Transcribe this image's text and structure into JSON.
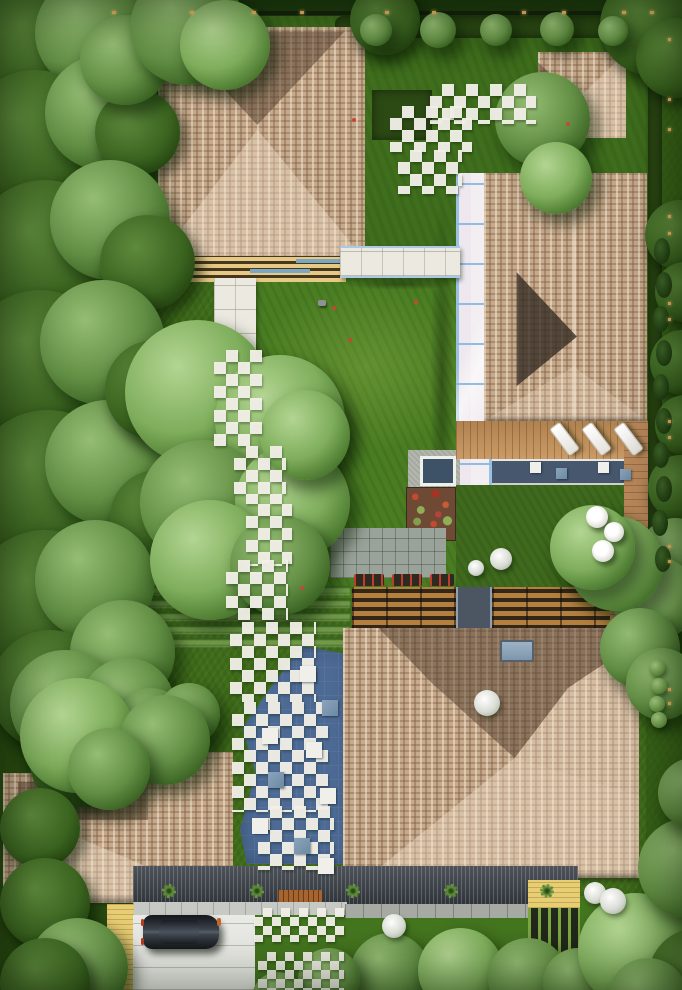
{
  "title": "aerial-top-view-residential-garden-render",
  "palette": {
    "lawn": "#3e6a1b",
    "lawn_bright": "#4a7d22",
    "boundary_dark": "#1d3a0e",
    "roof_shingle": "#c7a98b",
    "roof_dark_slope": "#54402f",
    "roof_light_slope": "#f4e3cc",
    "paver_white": "#f1efe9",
    "paving_blue": "#4d6a94",
    "pool_water": "#47586e",
    "glass_walkway": "#cfe0f0",
    "deck_wood": "#c1905a",
    "slat_wood": "#b5803f",
    "canopy_dark": "#3e444b",
    "driveway": "#e9eae5",
    "deck_yellow": "#e7cd74",
    "flower_red": "#c24a33",
    "light_warm": "#f0b25a",
    "car_body": "#14171b"
  },
  "scene": {
    "trees": [
      [
        -30,
        -20,
        130,
        "d"
      ],
      [
        35,
        -25,
        115,
        "m"
      ],
      [
        -35,
        70,
        140,
        "d"
      ],
      [
        45,
        55,
        115,
        "m"
      ],
      [
        95,
        90,
        85,
        "d"
      ],
      [
        80,
        15,
        90,
        "m"
      ],
      [
        -30,
        180,
        150,
        "d"
      ],
      [
        50,
        160,
        120,
        "m"
      ],
      [
        100,
        215,
        95,
        "d"
      ],
      [
        -35,
        290,
        150,
        "d"
      ],
      [
        40,
        280,
        125,
        "m"
      ],
      [
        -30,
        410,
        155,
        "d"
      ],
      [
        45,
        400,
        125,
        "m"
      ],
      [
        105,
        340,
        100,
        "d"
      ],
      [
        110,
        470,
        95,
        "d"
      ],
      [
        -30,
        530,
        150,
        "d"
      ],
      [
        35,
        520,
        120,
        "m"
      ],
      [
        -10,
        630,
        120,
        "d"
      ],
      [
        70,
        600,
        105,
        "m"
      ],
      [
        125,
        320,
        145,
        "l"
      ],
      [
        215,
        355,
        130,
        "l"
      ],
      [
        140,
        440,
        125,
        "m"
      ],
      [
        235,
        445,
        115,
        "l"
      ],
      [
        260,
        390,
        90,
        "l"
      ],
      [
        150,
        500,
        120,
        "l"
      ],
      [
        230,
        515,
        100,
        "m"
      ],
      [
        130,
        -30,
        115,
        "m"
      ],
      [
        180,
        0,
        90,
        "l"
      ],
      [
        350,
        -15,
        70,
        "d"
      ],
      [
        600,
        -25,
        100,
        "d"
      ],
      [
        636,
        18,
        80,
        "d"
      ],
      [
        360,
        14,
        32,
        "m"
      ],
      [
        420,
        12,
        36,
        "m"
      ],
      [
        480,
        14,
        32,
        "m"
      ],
      [
        540,
        12,
        34,
        "m"
      ],
      [
        598,
        16,
        30,
        "m"
      ],
      [
        495,
        72,
        95,
        "m"
      ],
      [
        520,
        142,
        72,
        "l"
      ],
      [
        645,
        200,
        70,
        "d"
      ],
      [
        655,
        262,
        60,
        "d"
      ],
      [
        650,
        330,
        65,
        "d"
      ],
      [
        655,
        395,
        60,
        "d"
      ],
      [
        648,
        455,
        65,
        "d"
      ],
      [
        638,
        518,
        75,
        "m"
      ],
      [
        612,
        556,
        85,
        "l"
      ],
      [
        568,
        516,
        95,
        "l"
      ],
      [
        550,
        505,
        85,
        "l"
      ],
      [
        600,
        608,
        80,
        "m"
      ],
      [
        626,
        648,
        72,
        "m"
      ],
      [
        10,
        650,
        110,
        "m"
      ],
      [
        80,
        658,
        95,
        "m"
      ],
      [
        30,
        718,
        90,
        "d"
      ],
      [
        110,
        688,
        80,
        "m"
      ],
      [
        158,
        683,
        62,
        "m"
      ],
      [
        20,
        678,
        115,
        "l"
      ],
      [
        120,
        695,
        90,
        "m"
      ],
      [
        68,
        728,
        82,
        "m"
      ],
      [
        0,
        788,
        80,
        "d"
      ],
      [
        0,
        858,
        90,
        "d"
      ],
      [
        28,
        918,
        100,
        "m"
      ],
      [
        0,
        938,
        90,
        "d"
      ],
      [
        350,
        933,
        80,
        "m"
      ],
      [
        418,
        928,
        85,
        "l"
      ],
      [
        488,
        938,
        80,
        "m"
      ],
      [
        543,
        948,
        70,
        "m"
      ],
      [
        298,
        948,
        62,
        "m"
      ],
      [
        252,
        972,
        52,
        "m"
      ],
      [
        578,
        893,
        115,
        "l"
      ],
      [
        638,
        818,
        100,
        "m"
      ],
      [
        648,
        928,
        100,
        "d"
      ],
      [
        608,
        958,
        80,
        "m"
      ],
      [
        658,
        758,
        70,
        "m"
      ]
    ],
    "conifers_right": [
      [
        654,
        238
      ],
      [
        656,
        272
      ],
      [
        653,
        306
      ],
      [
        656,
        340
      ],
      [
        653,
        374
      ],
      [
        656,
        408
      ],
      [
        653,
        442
      ],
      [
        656,
        476
      ],
      [
        652,
        510
      ],
      [
        655,
        546
      ]
    ],
    "hedge_balls": [
      [
        649,
        660
      ],
      [
        651,
        678
      ],
      [
        649,
        696
      ],
      [
        651,
        712
      ]
    ],
    "checker_clusters": [
      [
        430,
        84,
        106,
        40
      ],
      [
        390,
        106,
        82,
        46
      ],
      [
        398,
        150,
        64,
        44
      ],
      [
        214,
        350,
        48,
        96
      ],
      [
        234,
        446,
        52,
        58
      ],
      [
        246,
        504,
        46,
        62
      ],
      [
        226,
        560,
        62,
        60
      ],
      [
        230,
        622,
        86,
        80
      ],
      [
        232,
        702,
        96,
        110
      ],
      [
        258,
        806,
        76,
        64
      ]
    ],
    "checker_green": [
      [
        254,
        908,
        90,
        34
      ],
      [
        258,
        952,
        86,
        38
      ]
    ],
    "terrace_tiles": [
      [
        300,
        666,
        "w"
      ],
      [
        322,
        700,
        "g"
      ],
      [
        262,
        728,
        "w"
      ],
      [
        306,
        742,
        "w"
      ],
      [
        268,
        772,
        "g"
      ],
      [
        320,
        788,
        "w"
      ],
      [
        252,
        818,
        "w"
      ],
      [
        294,
        838,
        "g"
      ],
      [
        318,
        858,
        "w"
      ]
    ],
    "pool_pads": [
      [
        530,
        462,
        "w"
      ],
      [
        556,
        468,
        "g"
      ],
      [
        598,
        462,
        "w"
      ],
      [
        620,
        469,
        "g"
      ]
    ],
    "lounges": [
      [
        558,
        422
      ],
      [
        590,
        422
      ],
      [
        622,
        422
      ]
    ],
    "umbrellas": [
      [
        586,
        506,
        22
      ],
      [
        604,
        522,
        20
      ],
      [
        592,
        540,
        22
      ]
    ],
    "white_shrubs": [
      [
        490,
        548,
        22
      ],
      [
        468,
        560,
        16
      ],
      [
        474,
        690,
        26
      ],
      [
        584,
        882,
        22
      ],
      [
        600,
        888,
        26
      ],
      [
        382,
        914,
        24
      ]
    ],
    "palms": [
      [
        162,
        884
      ],
      [
        250,
        884
      ],
      [
        346,
        884
      ],
      [
        444,
        884
      ],
      [
        540,
        884
      ]
    ],
    "fence_lights_top": [
      112,
      190,
      252,
      300,
      385,
      432,
      522,
      562,
      622,
      650
    ],
    "fence_lights_right": [
      38,
      98,
      128,
      215,
      232,
      302,
      318,
      420,
      436,
      545,
      560,
      688,
      702
    ],
    "flower_dots": [
      [
        332,
        306
      ],
      [
        414,
        300
      ],
      [
        352,
        118
      ],
      [
        566,
        122
      ],
      [
        300,
        586
      ],
      [
        348,
        338
      ]
    ],
    "planters": [
      [
        354,
        574,
        30
      ],
      [
        392,
        574,
        30
      ],
      [
        430,
        574,
        24
      ]
    ]
  }
}
